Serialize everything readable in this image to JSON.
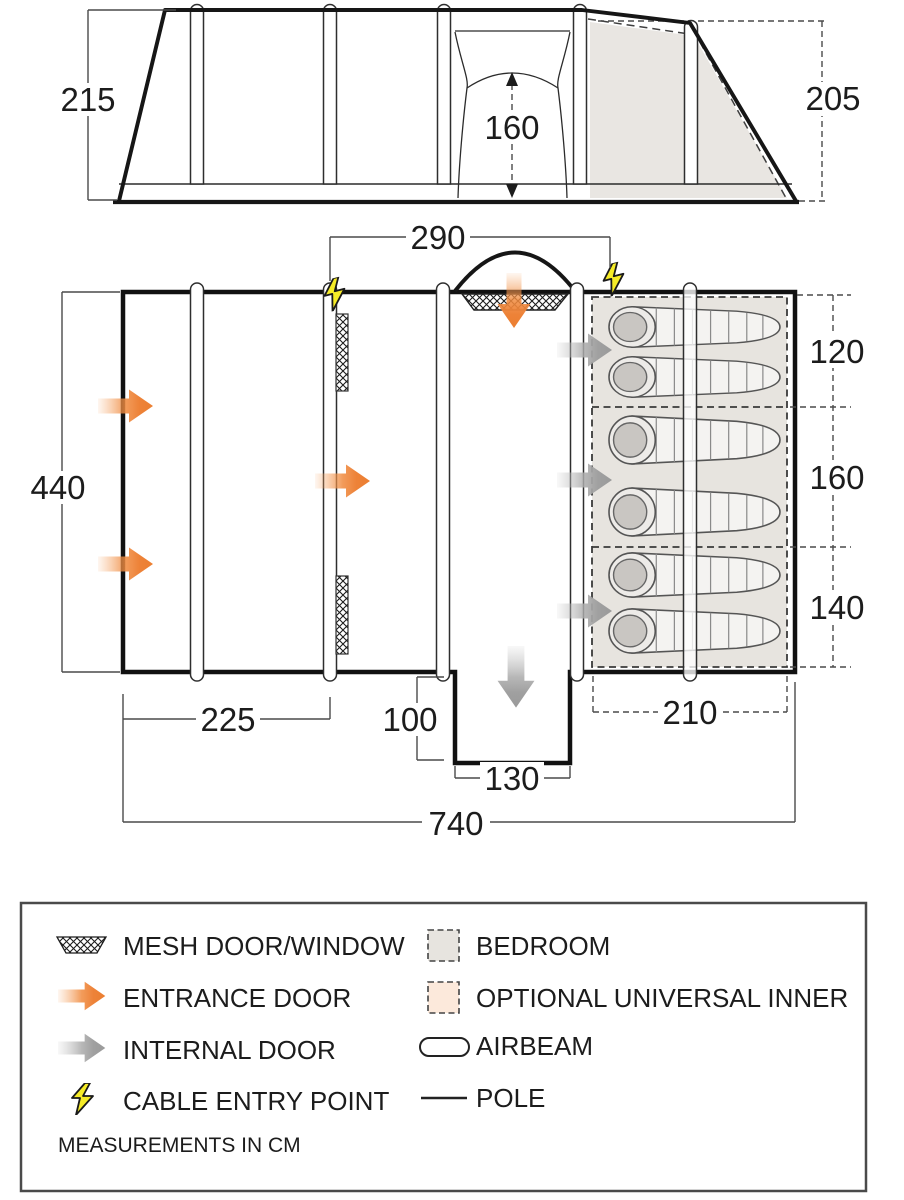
{
  "side_view": {
    "height_left": "215",
    "height_right": "205",
    "door_height": "160"
  },
  "floor_plan": {
    "front_width": "290",
    "depth": "440",
    "bedroom_sections": [
      "120",
      "160",
      "140"
    ],
    "living_length": "225",
    "porch_depth": "100",
    "porch_width": "130",
    "bedroom_depth": "210",
    "total_length": "740"
  },
  "legend": {
    "left": [
      {
        "label": "MESH DOOR/WINDOW",
        "symbol": "mesh-swatch"
      },
      {
        "label": "ENTRANCE DOOR",
        "symbol": "entrance-arrow"
      },
      {
        "label": "INTERNAL DOOR",
        "symbol": "internal-arrow"
      },
      {
        "label": "CABLE ENTRY POINT",
        "symbol": "lightning-bolt"
      }
    ],
    "right": [
      {
        "label": "BEDROOM",
        "symbol": "bedroom-swatch"
      },
      {
        "label": "OPTIONAL UNIVERSAL INNER",
        "symbol": "inner-swatch"
      },
      {
        "label": "AIRBEAM",
        "symbol": "airbeam-capsule"
      },
      {
        "label": "POLE",
        "symbol": "pole-line"
      }
    ],
    "note": "MEASUREMENTS IN CM"
  },
  "colors": {
    "entrance_door": "#ec7f31",
    "internal_door": "#9f9f9f",
    "cable_entry": "#f6ec27",
    "bedroom_fill": "#e7e4df",
    "optional_inner_fill": "#fce9db",
    "outline": "#1a1a1a"
  }
}
